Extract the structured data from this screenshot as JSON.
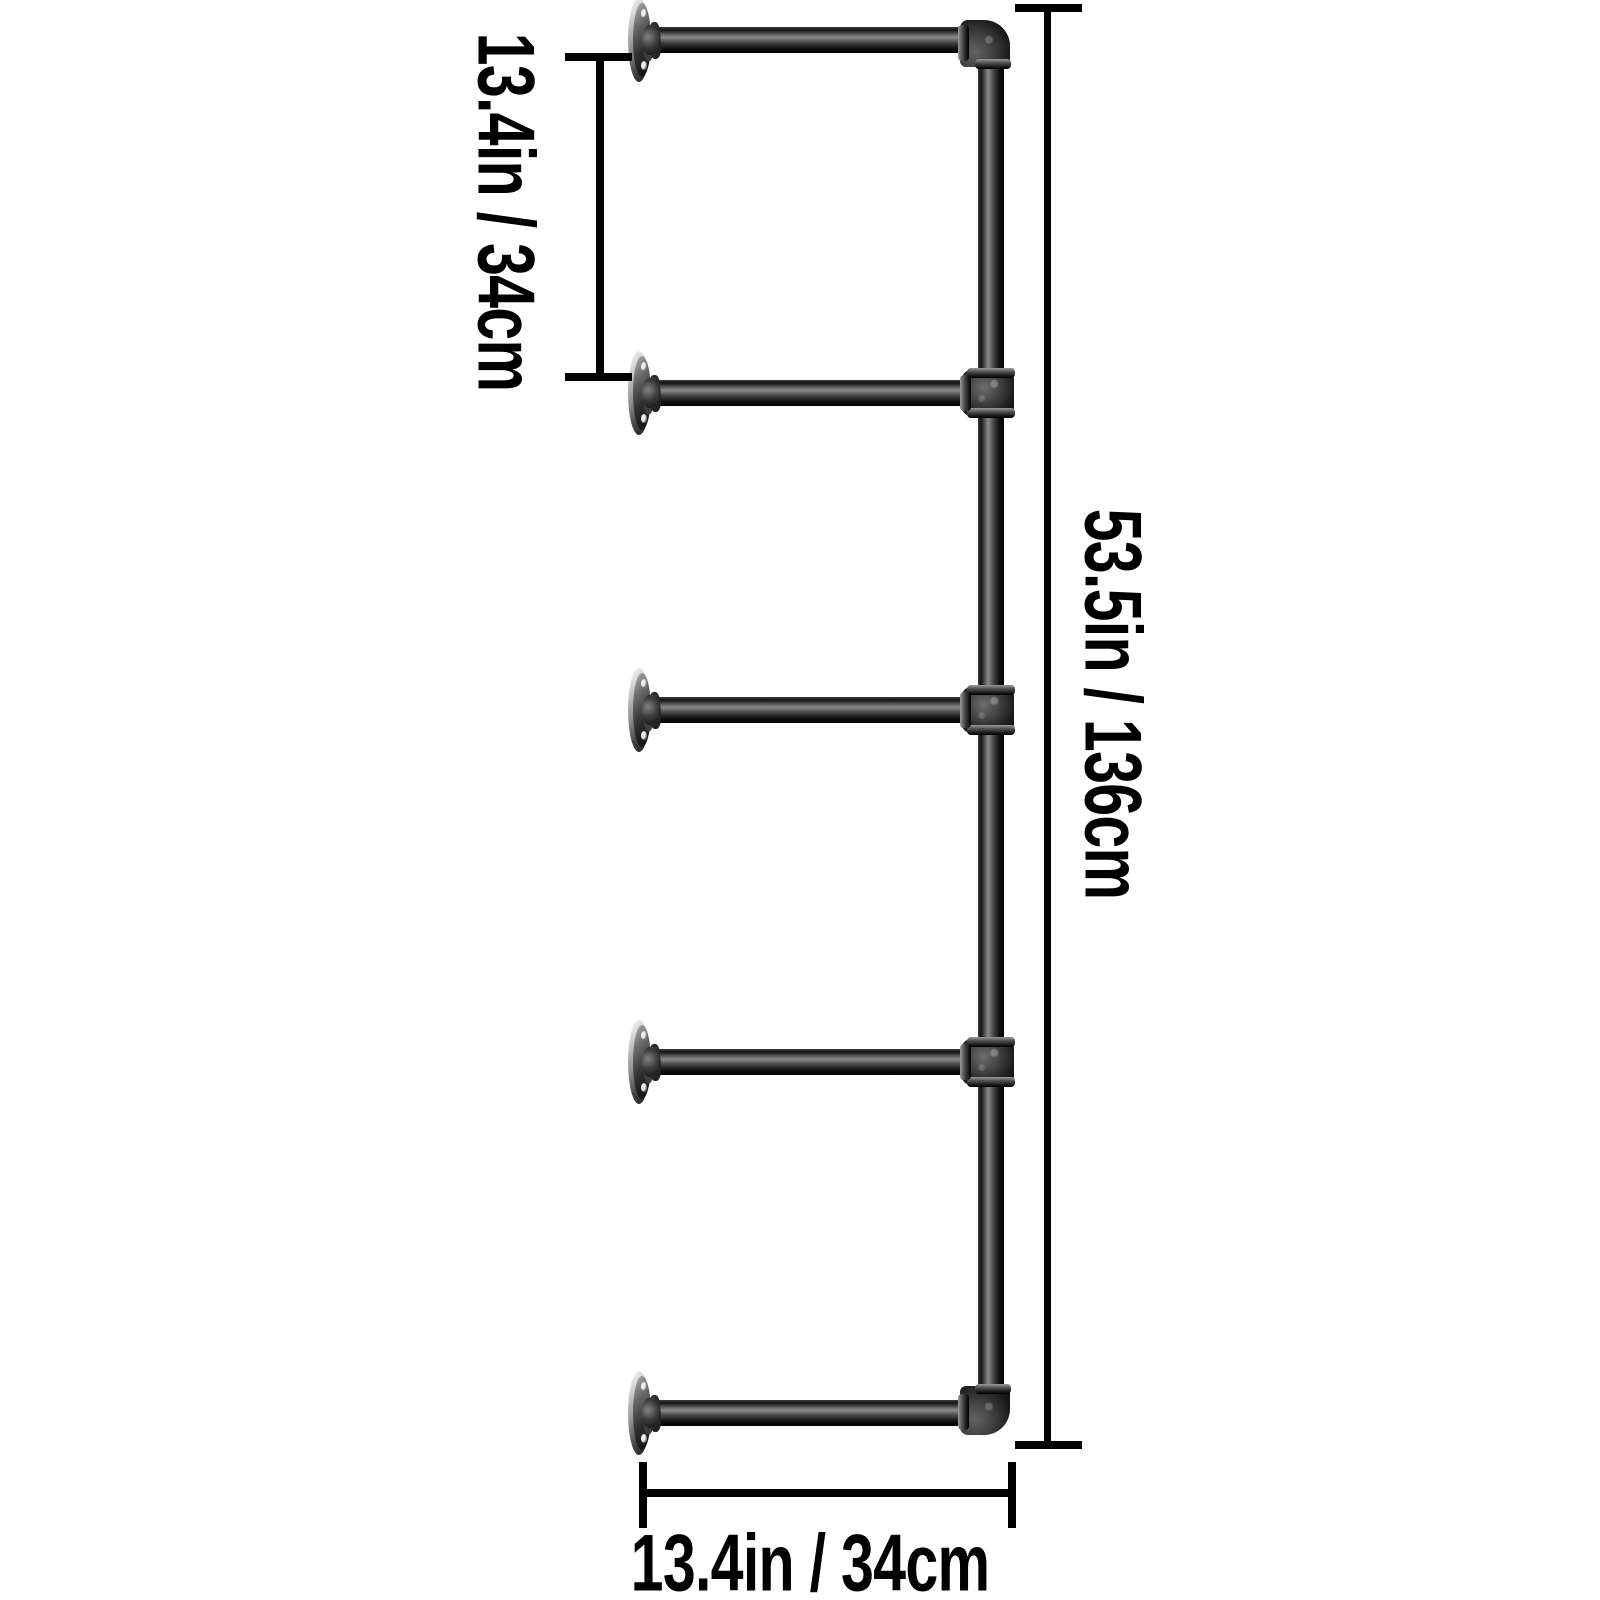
{
  "diagram": {
    "description": "Dimension diagram of a 5-tier wall-mounted industrial pipe shelf frame",
    "shelf_arm_count": 5
  },
  "labels": {
    "left_spacing": "13.4in / 34cm",
    "right_height": "53.5in / 136cm",
    "bottom_depth": "13.4in / 34cm"
  },
  "colors": {
    "background": "#ffffff",
    "text": "#000000",
    "dimension_line": "#000000",
    "pipe_dark": "#0a0a0a",
    "pipe_highlight": "#8a8a8a",
    "fitting_dark": "#1f1f1f",
    "flange_light": "#d2d2d2"
  }
}
